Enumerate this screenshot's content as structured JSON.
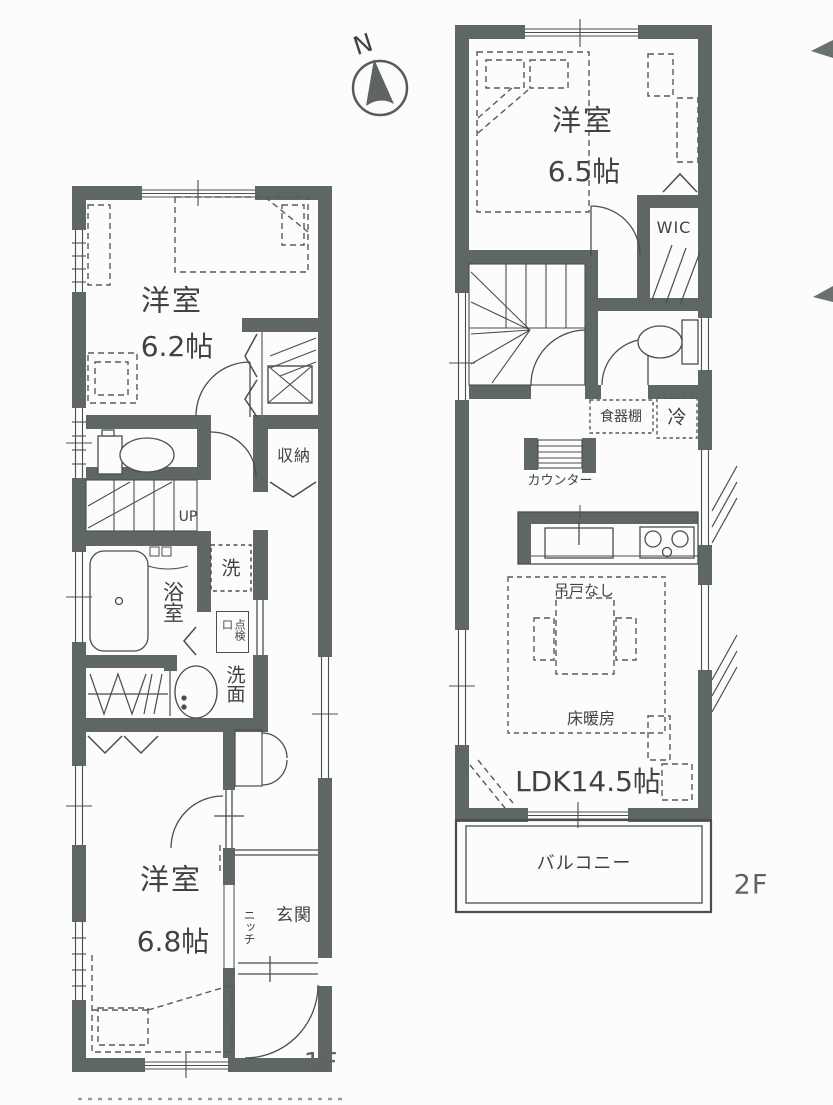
{
  "colors": {
    "wall": "#5f6763",
    "line": "#4a4f4c",
    "dashed": "#565c59",
    "text": "#3f4440",
    "paper": "#fcfcfa"
  },
  "compass": {
    "north_label": "N"
  },
  "floor_1f": {
    "label": "1F",
    "rooms": {
      "bedroom_top": {
        "name": "洋室",
        "size": "6.2帖"
      },
      "bedroom_bottom": {
        "name": "洋室",
        "size": "6.8帖"
      },
      "bathroom": "浴室",
      "washroom": "洗面",
      "washer": "洗",
      "inspection_hatch": "点検口",
      "storage": "収納",
      "stairs": "UP",
      "niche": "ニッチ",
      "entrance": "玄関"
    }
  },
  "floor_2f": {
    "label": "2F",
    "rooms": {
      "bedroom": {
        "name": "洋室",
        "size": "6.5帖"
      },
      "walk_in_closet": "WIC",
      "ldk": "LDK14.5帖",
      "cupboard": "食器棚",
      "refrigerator": "冷",
      "counter": "カウンター",
      "no_upper_cabinets": "吊戸なし",
      "floor_heating": "床暖房",
      "balcony": "バルコニー"
    }
  }
}
